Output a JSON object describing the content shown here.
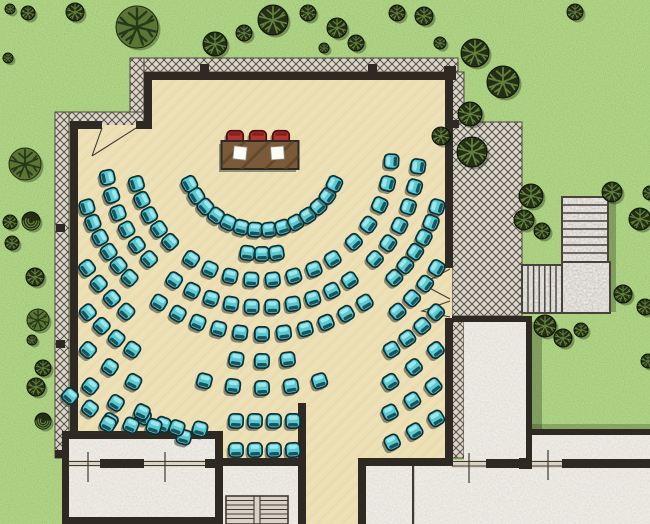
{
  "scene": {
    "kind": "architectural floor plan - outdoor banquet hall seating layout",
    "width": 650,
    "height": 524
  },
  "palette": {
    "grass": "#69a23b",
    "grass_shadow": "#3a5c1e",
    "floor_beige": "#ecdfb4",
    "floor_streak": "#d9c897",
    "hatch_bg": "#dbd5c9",
    "hatch_line": "#45403a",
    "wall_dark": "#2e2a23",
    "room_gray": "#d6d0c8",
    "plaza_gray": "#d2ccc4",
    "window_light": "#d9d3c6",
    "chair_teal": "#56cbd4",
    "chair_teal_stroke": "#0e2e33",
    "chair_teal_back": "#17454c",
    "chair_teal_highlight": "#aeeaed",
    "chair_red": "#b23330",
    "chair_red_stroke": "#4a100f",
    "chair_red_back": "#7e201e",
    "chair_red_highlight": "#d0564a",
    "table_wood": "#7a5a39",
    "table_streak": "#57412a",
    "paper_white": "#fdfdf8",
    "tree_dark_fill": "#222f15",
    "tree_dark_branch": "#64803d",
    "tree_olive_fill": "#5b7634",
    "tree_olive_branch": "#26381a",
    "shadow_rgba": "rgba(25,45,12,0.30)"
  },
  "head_table": {
    "x": 221.5,
    "y": 141,
    "width": 77,
    "height": 28,
    "chair_count": 3,
    "chair_centers_x": [
      235,
      258,
      281
    ],
    "chair_center_y": 139,
    "paper_count": 2,
    "papers": [
      {
        "x": 233.5,
        "y": 146.5,
        "size": 13,
        "rot": 6
      },
      {
        "x": 271.0,
        "y": 146.5,
        "size": 13,
        "rot": -4
      }
    ]
  },
  "seating": {
    "chair_size": 14.2,
    "center_x": 262,
    "center_y": 150,
    "arcs": [
      {
        "r": 80,
        "segments": [
          [
            155,
            25,
            14
          ]
        ]
      },
      {
        "r": 104,
        "segments": [
          [
            98,
            82,
            3
          ]
        ]
      },
      {
        "r": 130,
        "segments": [
          [
            165,
            135,
            5
          ],
          [
            123,
            57,
            8
          ],
          [
            45,
            5,
            5
          ]
        ]
      },
      {
        "r": 157,
        "segments": [
          [
            170,
            136,
            6
          ],
          [
            124,
            56,
            10
          ],
          [
            44,
            6,
            6
          ]
        ]
      },
      {
        "r": 184,
        "segments": [
          [
            162,
            136,
            6
          ],
          [
            124,
            56,
            11
          ],
          [
            44,
            18,
            6
          ]
        ]
      },
      {
        "r": 211,
        "segments": [
          [
            146,
            130,
            4
          ],
          [
            97,
            83,
            3
          ],
          [
            50,
            34,
            4
          ]
        ]
      },
      {
        "r": 238,
        "segments": [
          [
            137,
            123,
            4
          ],
          [
            104,
            76,
            5
          ],
          [
            57,
            43,
            4
          ]
        ]
      },
      {
        "r": 265,
        "segments": [
          [
            131,
            119,
            3
          ],
          [
            61,
            49,
            3
          ]
        ]
      },
      {
        "r": 292,
        "segments": [
          [
            126,
            114,
            3
          ],
          [
            64,
            54,
            3
          ]
        ]
      },
      {
        "r": 320,
        "segments": [
          [
            66,
            57,
            3
          ]
        ]
      }
    ],
    "straight_rows": [
      {
        "y": 421,
        "x_start": 236,
        "spacing": 19,
        "count": 4
      },
      {
        "y": 450,
        "x_start": 236,
        "spacing": 19,
        "count": 4
      }
    ],
    "lines": [
      {
        "x1": 70,
        "y1": 396,
        "x2": 110,
        "y2": 421,
        "count": 3
      },
      {
        "x1": 142,
        "y1": 412,
        "x2": 184,
        "y2": 437,
        "count": 3
      },
      {
        "x1": 108,
        "y1": 424,
        "x2": 200,
        "y2": 429,
        "count": 5
      }
    ]
  },
  "trees": [
    [
      10,
      9,
      5,
      "d"
    ],
    [
      28,
      13,
      7,
      "d"
    ],
    [
      8,
      58,
      5,
      "d"
    ],
    [
      75,
      12,
      9,
      "d"
    ],
    [
      137,
      27,
      21,
      "o"
    ],
    [
      215,
      44,
      12,
      "d"
    ],
    [
      244,
      33,
      8,
      "d"
    ],
    [
      273,
      20,
      15,
      "d"
    ],
    [
      308,
      13,
      8,
      "d"
    ],
    [
      337,
      28,
      10,
      "d"
    ],
    [
      356,
      43,
      8,
      "d"
    ],
    [
      324,
      48,
      5,
      "d"
    ],
    [
      397,
      13,
      8,
      "d"
    ],
    [
      424,
      16,
      9,
      "d"
    ],
    [
      440,
      43,
      6,
      "d"
    ],
    [
      575,
      12,
      8,
      "d"
    ],
    [
      475,
      53,
      14,
      "d"
    ],
    [
      503,
      82,
      16,
      "d"
    ],
    [
      470,
      114,
      12,
      "d"
    ],
    [
      472,
      152,
      15,
      "d"
    ],
    [
      441,
      136,
      9,
      "d"
    ],
    [
      531,
      196,
      12,
      "d"
    ],
    [
      524,
      220,
      10,
      "d"
    ],
    [
      542,
      231,
      8,
      "d"
    ],
    [
      612,
      192,
      10,
      "d"
    ],
    [
      640,
      219,
      11,
      "d"
    ],
    [
      650,
      193,
      7,
      "d"
    ],
    [
      623,
      294,
      9,
      "d"
    ],
    [
      645,
      307,
      8,
      "d"
    ],
    [
      545,
      326,
      11,
      "d"
    ],
    [
      563,
      338,
      9,
      "d"
    ],
    [
      581,
      330,
      7,
      "d"
    ],
    [
      648,
      361,
      7,
      "d"
    ],
    [
      25,
      164,
      16,
      "o"
    ],
    [
      31,
      221,
      9,
      "s"
    ],
    [
      10,
      222,
      7,
      "d"
    ],
    [
      12,
      243,
      7,
      "d"
    ],
    [
      35,
      277,
      9,
      "d"
    ],
    [
      38,
      320,
      11,
      "o"
    ],
    [
      32,
      340,
      5,
      "d"
    ],
    [
      43,
      368,
      8,
      "d"
    ],
    [
      36,
      387,
      9,
      "d"
    ],
    [
      43,
      421,
      8,
      "s"
    ]
  ],
  "stairs": {
    "north_exterior": {
      "x": 562,
      "y": 197,
      "width": 46,
      "height": 65,
      "treads": 7,
      "orientation": "horizontal-treads"
    },
    "east_exterior": {
      "x": 522,
      "y": 265,
      "width": 40,
      "height": 48,
      "treads": 6,
      "orientation": "vertical-treads"
    },
    "landing": {
      "x": 562,
      "y": 262,
      "width": 48,
      "height": 51
    },
    "interior_double_flight": {
      "x": 226,
      "y": 496,
      "width": 62,
      "height": 28,
      "treads_per_flight": 6
    }
  },
  "counts": {
    "guest_chairs": 138,
    "head_table_chairs": 3,
    "trees": 43
  }
}
